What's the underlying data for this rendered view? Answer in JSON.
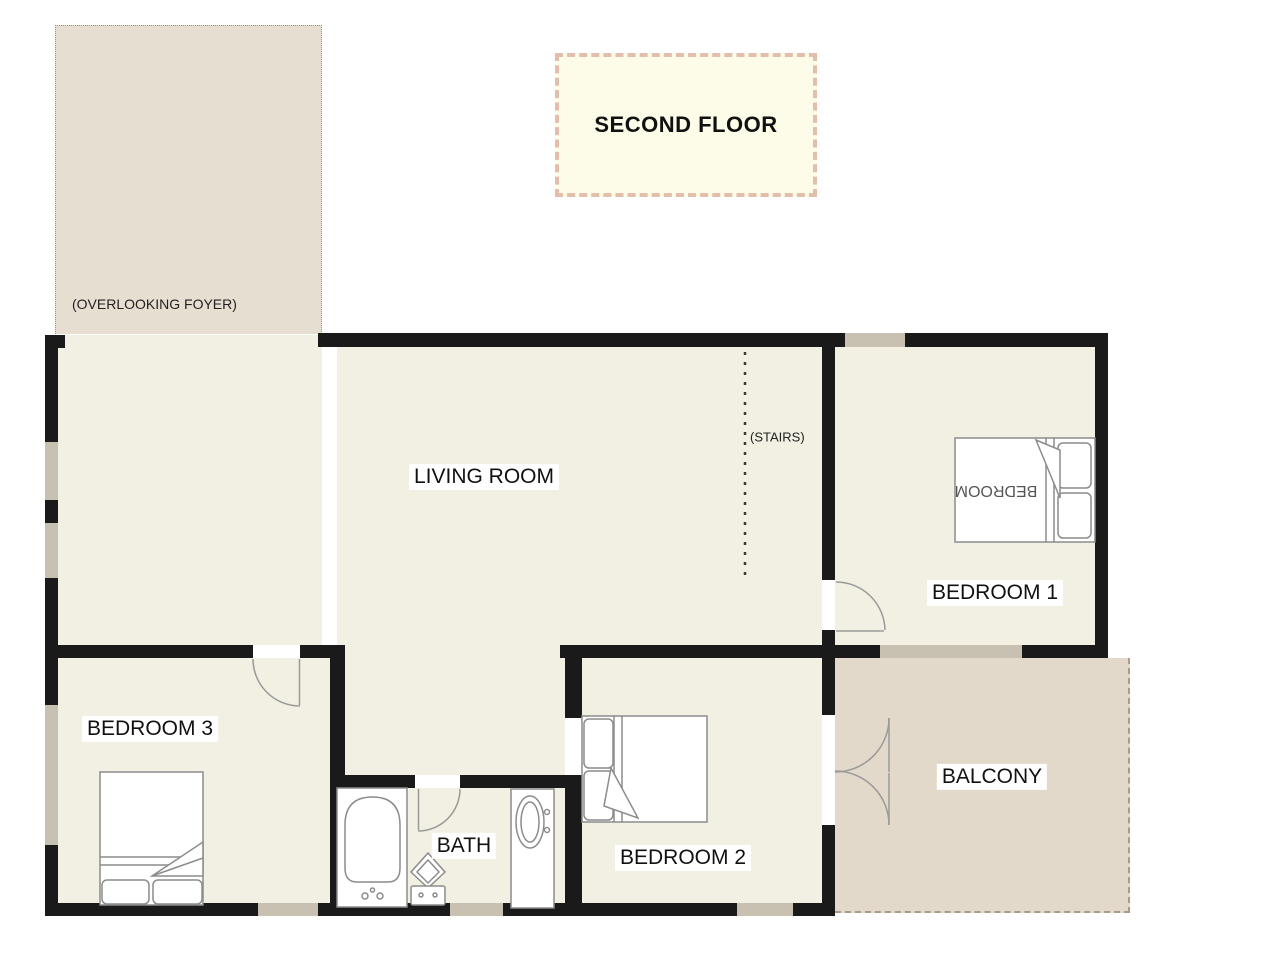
{
  "title_box": {
    "label": "SECOND FLOOR"
  },
  "areas": {
    "foyer": {
      "label": "(OVERLOOKING FOYER)"
    },
    "living_room": {
      "label": "LIVING ROOM"
    },
    "stairs": {
      "label": "(STAIRS)"
    },
    "bedroom1": {
      "label": "BEDROOM 1",
      "bed_label": "BEDROOM"
    },
    "bedroom2": {
      "label": "BEDROOM 2"
    },
    "bedroom3": {
      "label": "BEDROOM 3"
    },
    "bath": {
      "label": "BATH"
    },
    "balcony": {
      "label": "BALCONY"
    }
  },
  "colors": {
    "wall": "#1a1a1a",
    "room_floor": "#f2f0e2",
    "foyer_floor": "#e6ded0",
    "balcony_floor": "#e3d9ca",
    "window": "#c8c1b2",
    "title_fill": "#fcfce8",
    "title_border": "#e3bfab",
    "furniture_line": "#8c8c8c"
  }
}
